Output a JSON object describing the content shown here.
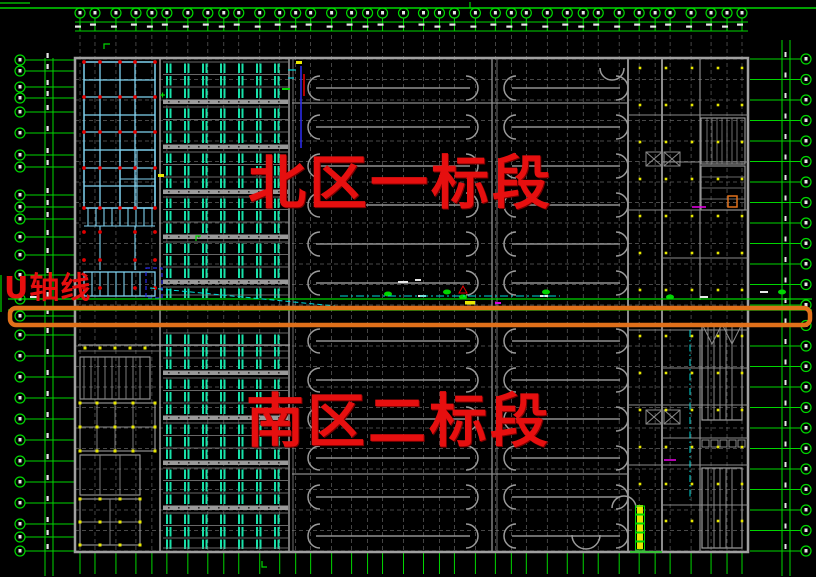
{
  "canvas": {
    "width": 816,
    "height": 577,
    "background": "#000000"
  },
  "labels": {
    "north_section": "北区一标段",
    "south_section": "南区二标段",
    "u_axis": "U轴线"
  },
  "colors": {
    "axis_green": "#00d600",
    "grid_dash_gray": "#616161",
    "wall_gray": "#9c9c9c",
    "wall_light": "#8a8a8a",
    "cyan_wall": "#7fd2f0",
    "rack_teal": "#18e2aa",
    "red_marker": "#e00000",
    "yellow_marker": "#e8e800",
    "orange_highlight": "#e0701a",
    "label_red": "#e60f0f",
    "dim_white": "#e8e8e8",
    "blue_line": "#2a2ae8",
    "cyan_line": "#00d8d8",
    "magenta_line": "#e000e0",
    "blue_dash_box": "#2a2ae8"
  },
  "axes": {
    "top": {
      "bubble_y": 13,
      "radius": 5,
      "x_start": 80,
      "x_end": 745,
      "count": 38,
      "dim_band_y": [
        22,
        31
      ]
    },
    "left": {
      "bubble_x": 20,
      "radius": 5,
      "dim_band_x": [
        45,
        53
      ],
      "y_list": [
        60,
        71,
        87,
        98,
        112,
        133,
        155,
        167,
        195,
        207,
        219,
        237,
        255,
        275,
        299,
        316,
        335,
        356,
        377,
        398,
        419,
        440,
        461,
        482,
        503,
        524,
        537,
        551
      ]
    },
    "right": {
      "bubble_x": 806,
      "radius": 5,
      "dim_band_x": [
        782,
        790
      ],
      "y_start": 59,
      "count": 25,
      "step": 20.5
    }
  },
  "building": {
    "x": 75,
    "y": 58,
    "w": 673,
    "h": 494
  },
  "u_axis_zone": {
    "green_line_y": [
      299,
      310
    ],
    "highlight_box": {
      "x": 10,
      "y": 308,
      "w": 800,
      "h": 17,
      "stroke_width": 4.5,
      "corner_radius": 6
    }
  },
  "top_border_line_y": 8
}
